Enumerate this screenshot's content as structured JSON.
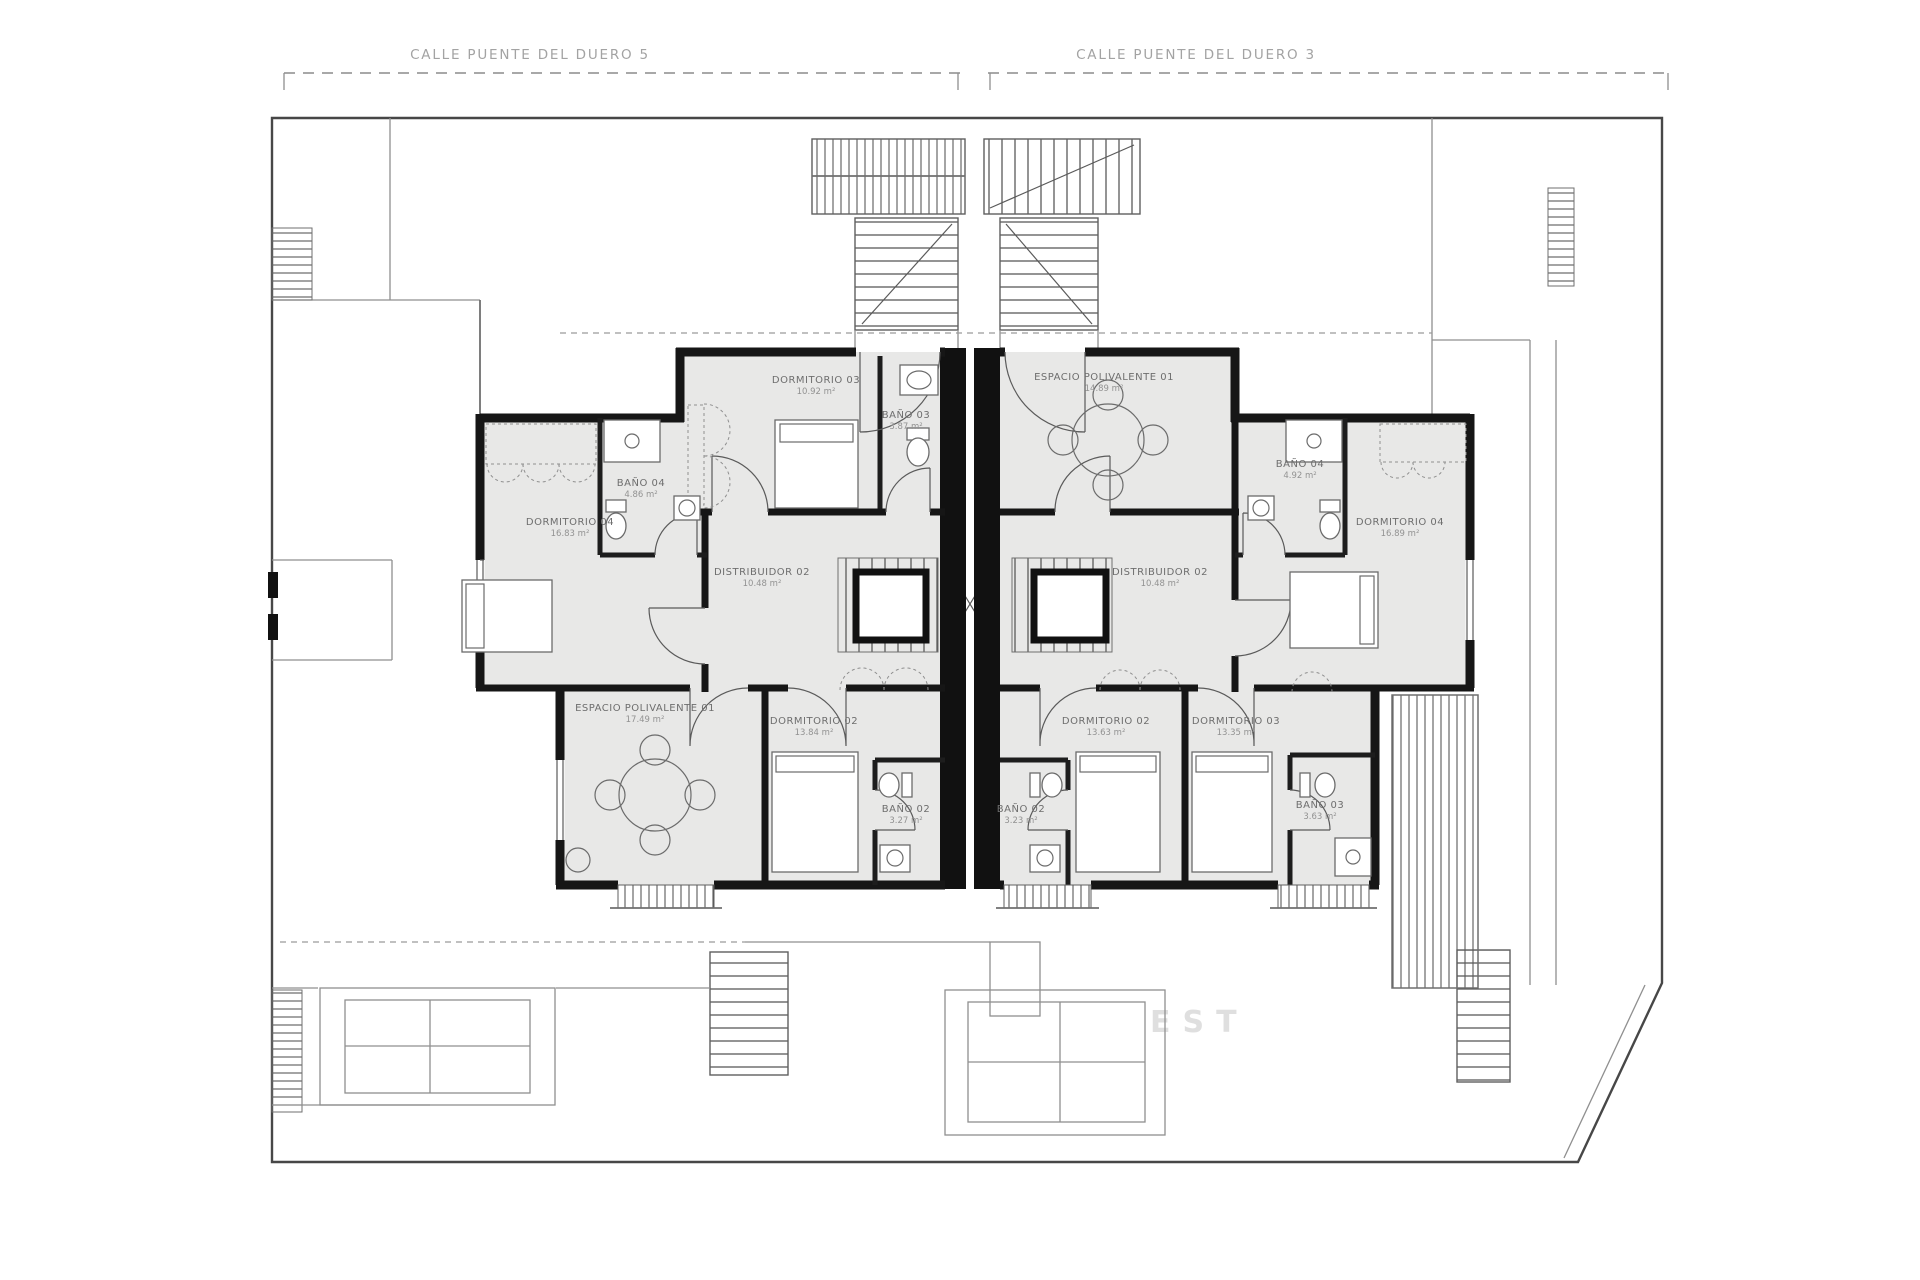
{
  "streets": {
    "left": "CALLE PUENTE DEL DUERO 5",
    "right": "CALLE PUENTE DEL DUERO 3"
  },
  "watermark": "EST",
  "rooms": [
    {
      "label": "DORMITORIO 03",
      "area": "10.92 m²"
    },
    {
      "label": "BAÑO 03",
      "area": "3.87 m²"
    },
    {
      "label": "BAÑO 04",
      "area": "4.86 m²"
    },
    {
      "label": "DORMITORIO 04",
      "area": "16.83 m²"
    },
    {
      "label": "DISTRIBUIDOR 02",
      "area": "10.48 m²"
    },
    {
      "label": "ESPACIO POLIVALENTE 01",
      "area": "17.49 m²"
    },
    {
      "label": "DORMITORIO 02",
      "area": "13.84 m²"
    },
    {
      "label": "BAÑO 02",
      "area": "3.27 m²"
    },
    {
      "label": "ESPACIO POLIVALENTE 01",
      "area": "14.89 m²"
    },
    {
      "label": "BAÑO 04",
      "area": "4.92 m²"
    },
    {
      "label": "DORMITORIO 04",
      "area": "16.89 m²"
    },
    {
      "label": "DISTRIBUIDOR 02",
      "area": "10.48 m²"
    },
    {
      "label": "DORMITORIO 02",
      "area": "13.63 m²"
    },
    {
      "label": "DORMITORIO 03",
      "area": "13.35 m²"
    },
    {
      "label": "BAÑO 02",
      "area": "3.23 m²"
    },
    {
      "label": "BAÑO 03",
      "area": "3.63 m²"
    }
  ]
}
